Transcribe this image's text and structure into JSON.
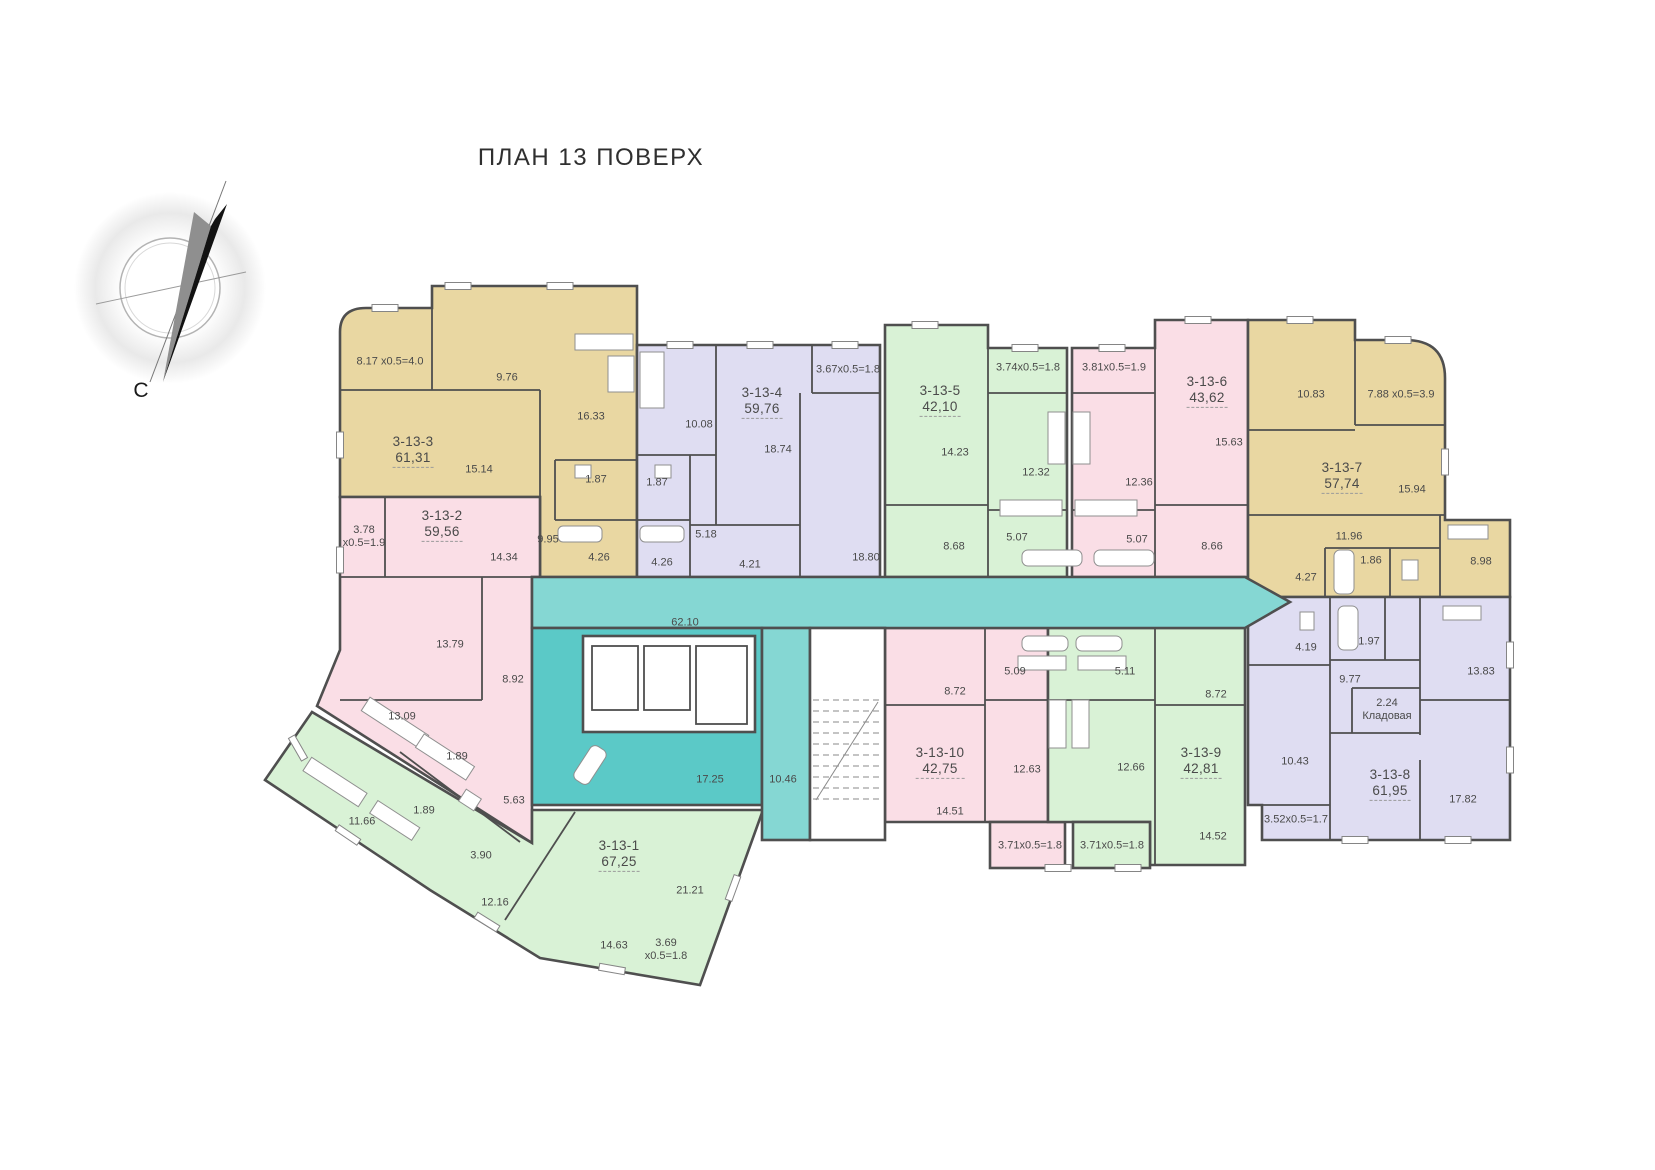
{
  "title": "ПЛАН 13 ПОВЕРХ",
  "compass": {
    "north_label": "С"
  },
  "palette": {
    "paper": "#ffffff",
    "wall": "#4f4f4f",
    "text": "#4a4a4a",
    "tan": "#e9d7a2",
    "pink": "#fadee6",
    "lavender": "#dfddf2",
    "green": "#d9f2d6",
    "teal": "#85d7d3",
    "teal_dark": "#5bc9c7"
  },
  "corridor": {
    "labels": [
      {
        "v": "62.10",
        "x": 685,
        "y": 623
      },
      {
        "v": "17.25",
        "x": 710,
        "y": 780
      },
      {
        "v": "10.46",
        "x": 783,
        "y": 780
      }
    ]
  },
  "apartments": [
    {
      "id": "3-13-1",
      "area": "67,25",
      "color": "green",
      "hx": 619,
      "hy": 846,
      "rooms": [
        {
          "v": "11.66",
          "x": 362,
          "y": 822
        },
        {
          "v": "1.89",
          "x": 424,
          "y": 811
        },
        {
          "v": "3.90",
          "x": 481,
          "y": 856
        },
        {
          "v": "12.16",
          "x": 495,
          "y": 903
        },
        {
          "v": "14.63",
          "x": 614,
          "y": 946
        },
        {
          "v": "3.69",
          "v2": "x0.5=1.8",
          "x": 666,
          "y": 950
        },
        {
          "v": "21.21",
          "x": 690,
          "y": 891
        }
      ]
    },
    {
      "id": "3-13-2",
      "area": "59,56",
      "color": "pink",
      "hx": 442,
      "hy": 516,
      "rooms": [
        {
          "v": "3.78",
          "v2": "x0.5=1.9",
          "x": 364,
          "y": 537
        },
        {
          "v": "14.34",
          "x": 504,
          "y": 558
        },
        {
          "v": "13.79",
          "x": 450,
          "y": 645
        },
        {
          "v": "8.92",
          "x": 513,
          "y": 680
        },
        {
          "v": "13.09",
          "x": 402,
          "y": 717
        },
        {
          "v": "1.89",
          "x": 457,
          "y": 757
        },
        {
          "v": "5.63",
          "x": 514,
          "y": 801
        }
      ]
    },
    {
      "id": "3-13-3",
      "area": "61,31",
      "color": "tan",
      "hx": 413,
      "hy": 442,
      "rooms": [
        {
          "v": "8.17 x0.5=4.0",
          "x": 390,
          "y": 362
        },
        {
          "v": "9.76",
          "x": 507,
          "y": 378
        },
        {
          "v": "16.33",
          "x": 591,
          "y": 417
        },
        {
          "v": "15.14",
          "x": 479,
          "y": 470
        },
        {
          "v": "1.87",
          "x": 596,
          "y": 480
        },
        {
          "v": "9.95",
          "x": 548,
          "y": 540
        },
        {
          "v": "4.26",
          "x": 599,
          "y": 558
        }
      ]
    },
    {
      "id": "3-13-4",
      "area": "59,76",
      "color": "lavender",
      "hx": 762,
      "hy": 393,
      "rooms": [
        {
          "v": "3.67x0.5=1.8",
          "x": 848,
          "y": 370
        },
        {
          "v": "10.08",
          "x": 699,
          "y": 425
        },
        {
          "v": "18.74",
          "x": 778,
          "y": 450
        },
        {
          "v": "1.87",
          "x": 657,
          "y": 483
        },
        {
          "v": "5.18",
          "x": 706,
          "y": 535
        },
        {
          "v": "4.26",
          "x": 662,
          "y": 563
        },
        {
          "v": "4.21",
          "x": 750,
          "y": 565
        },
        {
          "v": "18.80",
          "x": 866,
          "y": 558
        }
      ]
    },
    {
      "id": "3-13-5",
      "area": "42,10",
      "color": "green",
      "hx": 940,
      "hy": 391,
      "rooms": [
        {
          "v": "3.74x0.5=1.8",
          "x": 1028,
          "y": 368
        },
        {
          "v": "14.23",
          "x": 955,
          "y": 453
        },
        {
          "v": "12.32",
          "x": 1036,
          "y": 473
        },
        {
          "v": "5.07",
          "x": 1017,
          "y": 538
        },
        {
          "v": "8.68",
          "x": 954,
          "y": 547
        }
      ]
    },
    {
      "id": "3-13-6",
      "area": "43,62",
      "color": "pink",
      "hx": 1207,
      "hy": 382,
      "rooms": [
        {
          "v": "3.81x0.5=1.9",
          "x": 1114,
          "y": 368
        },
        {
          "v": "15.63",
          "x": 1229,
          "y": 443
        },
        {
          "v": "12.36",
          "x": 1139,
          "y": 483
        },
        {
          "v": "5.07",
          "x": 1137,
          "y": 540
        },
        {
          "v": "8.66",
          "x": 1212,
          "y": 547
        }
      ]
    },
    {
      "id": "3-13-7",
      "area": "57,74",
      "color": "tan",
      "hx": 1342,
      "hy": 468,
      "rooms": [
        {
          "v": "10.83",
          "x": 1311,
          "y": 395
        },
        {
          "v": "7.88 x0.5=3.9",
          "x": 1401,
          "y": 395
        },
        {
          "v": "15.94",
          "x": 1412,
          "y": 490
        },
        {
          "v": "11.96",
          "x": 1349,
          "y": 537
        },
        {
          "v": "1.86",
          "x": 1371,
          "y": 561
        },
        {
          "v": "4.27",
          "x": 1306,
          "y": 578
        },
        {
          "v": "8.98",
          "x": 1481,
          "y": 562
        }
      ]
    },
    {
      "id": "3-13-8",
      "area": "61,95",
      "color": "lavender",
      "hx": 1390,
      "hy": 775,
      "rooms": [
        {
          "v": "4.19",
          "x": 1306,
          "y": 648
        },
        {
          "v": "1.97",
          "x": 1369,
          "y": 642
        },
        {
          "v": "9.77",
          "x": 1350,
          "y": 680
        },
        {
          "v": "2.24",
          "v2": "Кладовая",
          "x": 1387,
          "y": 710
        },
        {
          "v": "13.83",
          "x": 1481,
          "y": 672
        },
        {
          "v": "10.43",
          "x": 1295,
          "y": 762
        },
        {
          "v": "17.82",
          "x": 1463,
          "y": 800
        },
        {
          "v": "3.52x0.5=1.7",
          "x": 1296,
          "y": 820
        }
      ]
    },
    {
      "id": "3-13-9",
      "area": "42,81",
      "color": "green",
      "hx": 1201,
      "hy": 753,
      "rooms": [
        {
          "v": "5.11",
          "x": 1125,
          "y": 672
        },
        {
          "v": "8.72",
          "x": 1216,
          "y": 695
        },
        {
          "v": "12.66",
          "x": 1131,
          "y": 768
        },
        {
          "v": "14.52",
          "x": 1213,
          "y": 837
        },
        {
          "v": "3.71x0.5=1.8",
          "x": 1112,
          "y": 846
        }
      ]
    },
    {
      "id": "3-13-10",
      "area": "42,75",
      "color": "pink",
      "hx": 940,
      "hy": 753,
      "rooms": [
        {
          "v": "5.09",
          "x": 1015,
          "y": 672
        },
        {
          "v": "8.72",
          "x": 955,
          "y": 692
        },
        {
          "v": "12.63",
          "x": 1027,
          "y": 770
        },
        {
          "v": "14.51",
          "x": 950,
          "y": 812
        },
        {
          "v": "3.71x0.5=1.8",
          "x": 1030,
          "y": 846
        }
      ]
    }
  ]
}
